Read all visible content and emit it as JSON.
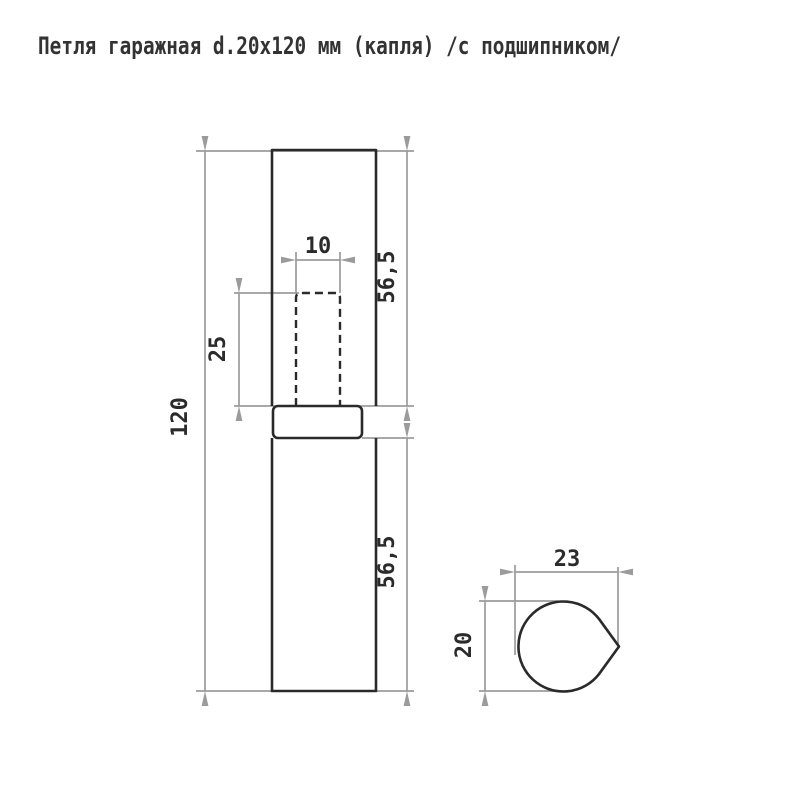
{
  "title": {
    "text": "Петля гаражная d.20x120 мм (капля) /с подшипником/"
  },
  "drawing": {
    "front_view": {
      "dim_total_length": "120",
      "dim_upper_body": "56,5",
      "dim_lower_body": "56,5",
      "dim_pin_width": "10",
      "dim_pin_depth": "25"
    },
    "section_view": {
      "dim_width": "23",
      "dim_height": "20"
    },
    "colors": {
      "outline": "#2a2a2a",
      "dimension_lines": "#9b9b9b",
      "label_text": "#2b2b2b",
      "background": "#ffffff"
    }
  }
}
